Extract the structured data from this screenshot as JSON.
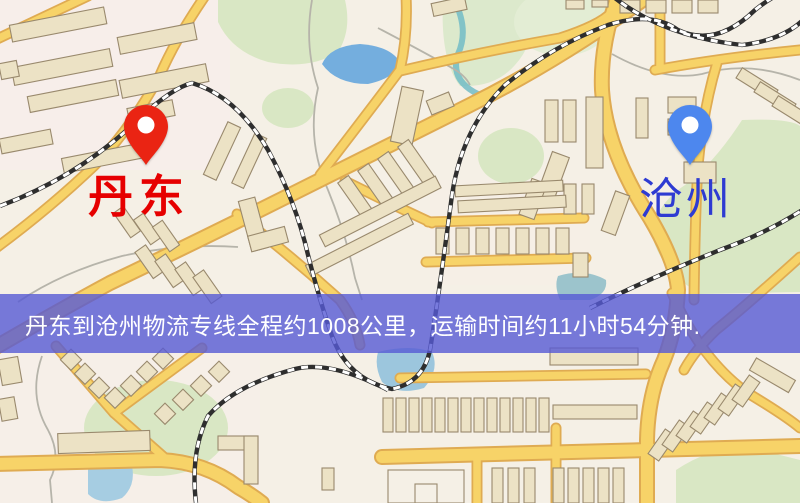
{
  "map": {
    "markers": {
      "origin": {
        "label": "丹东",
        "pin_color": "#ea2413",
        "label_color": "#e60000"
      },
      "destination": {
        "label": "沧州",
        "pin_color": "#4d87ee",
        "label_color": "#2e3bd2"
      }
    },
    "banner": {
      "text": "丹东到沧州物流专线全程约1008公里，运输时间约11小时54分钟.",
      "bg_color": "rgba(86,90,212,0.8)",
      "text_color": "#ffffff"
    },
    "route": {
      "origin_city": "丹东",
      "destination_city": "沧州",
      "distance_km": "1008",
      "duration": "11小时54分钟"
    }
  }
}
